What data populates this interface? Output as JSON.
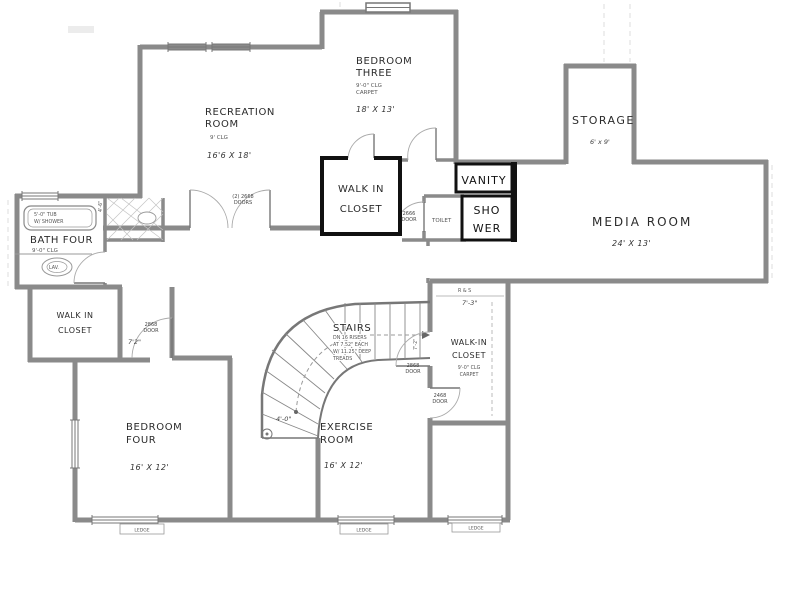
{
  "plan": {
    "rooms": {
      "recreation": {
        "l1": "RECREATION",
        "l2": "ROOM",
        "clg": "9' CLG",
        "dims": "16'6 X 18'"
      },
      "bedroom3": {
        "l1": "BEDROOM",
        "l2": "THREE",
        "clg": "9'-0\" CLG",
        "floor": "CARPET",
        "dims": "18' X 13'"
      },
      "storage": {
        "l1": "STORAGE",
        "dims": "6' x 9'"
      },
      "media": {
        "l1": "MEDIA ROOM",
        "dims": "24' X 13'"
      },
      "closet_center": {
        "l1": "WALK IN",
        "l2": "CLOSET"
      },
      "vanity": {
        "l1": "VANITY"
      },
      "shower": {
        "l1": "SHO",
        "l2": "WER"
      },
      "toilet": {
        "l1": "TOILET"
      },
      "bath4": {
        "l1": "BATH FOUR",
        "clg": "9'-0\" CLG",
        "tub1": "5'-0\" TUB",
        "tub2": "W/ SHOWER",
        "lav": "LAV."
      },
      "closet_left": {
        "l1": "WALK IN",
        "l2": "CLOSET"
      },
      "bedroom4": {
        "l1": "BEDROOM",
        "l2": "FOUR",
        "dims": "16' X 12'"
      },
      "exercise": {
        "l1": "EXERCISE",
        "l2": "ROOM",
        "dims": "16' X 12'"
      },
      "closet_right": {
        "shelf": "R & S",
        "w": "7'-3\"",
        "l1": "WALK-IN",
        "l2": "CLOSET",
        "clg": "9'-0\" CLG",
        "floor": "CARPET"
      },
      "stairs": {
        "l1": "STAIRS",
        "n1": "DN 16 RISERS",
        "n2": "AT 7.52\" EACH",
        "n3": "W/ 11.25\" DEEP",
        "n4": "TREADS",
        "r": "4'-0\""
      }
    },
    "doors": {
      "double": {
        "l1": "(2) 2668",
        "l2": "DOORS"
      },
      "toilet": {
        "l1": "2666",
        "l2": "DOOR"
      },
      "hall_left": {
        "l1": "2868",
        "l2": "DOOR"
      },
      "hall_left_dim": "7'2\"",
      "exercise": {
        "l1": "2868",
        "l2": "DOOR"
      },
      "closet_right": {
        "l1": "2468",
        "l2": "DOOR"
      },
      "dim_v1": "4'-6\"",
      "dim_v2": "7'-2\""
    },
    "windows": {
      "ledge1": "LEDGE",
      "ledge2": "LEDGE",
      "ledge3": "LEDGE"
    },
    "colors": {
      "wall": "#8a8a8a",
      "overlay": "#111111",
      "text": "#2b2b2b",
      "faint": "#bdbdbd"
    }
  }
}
